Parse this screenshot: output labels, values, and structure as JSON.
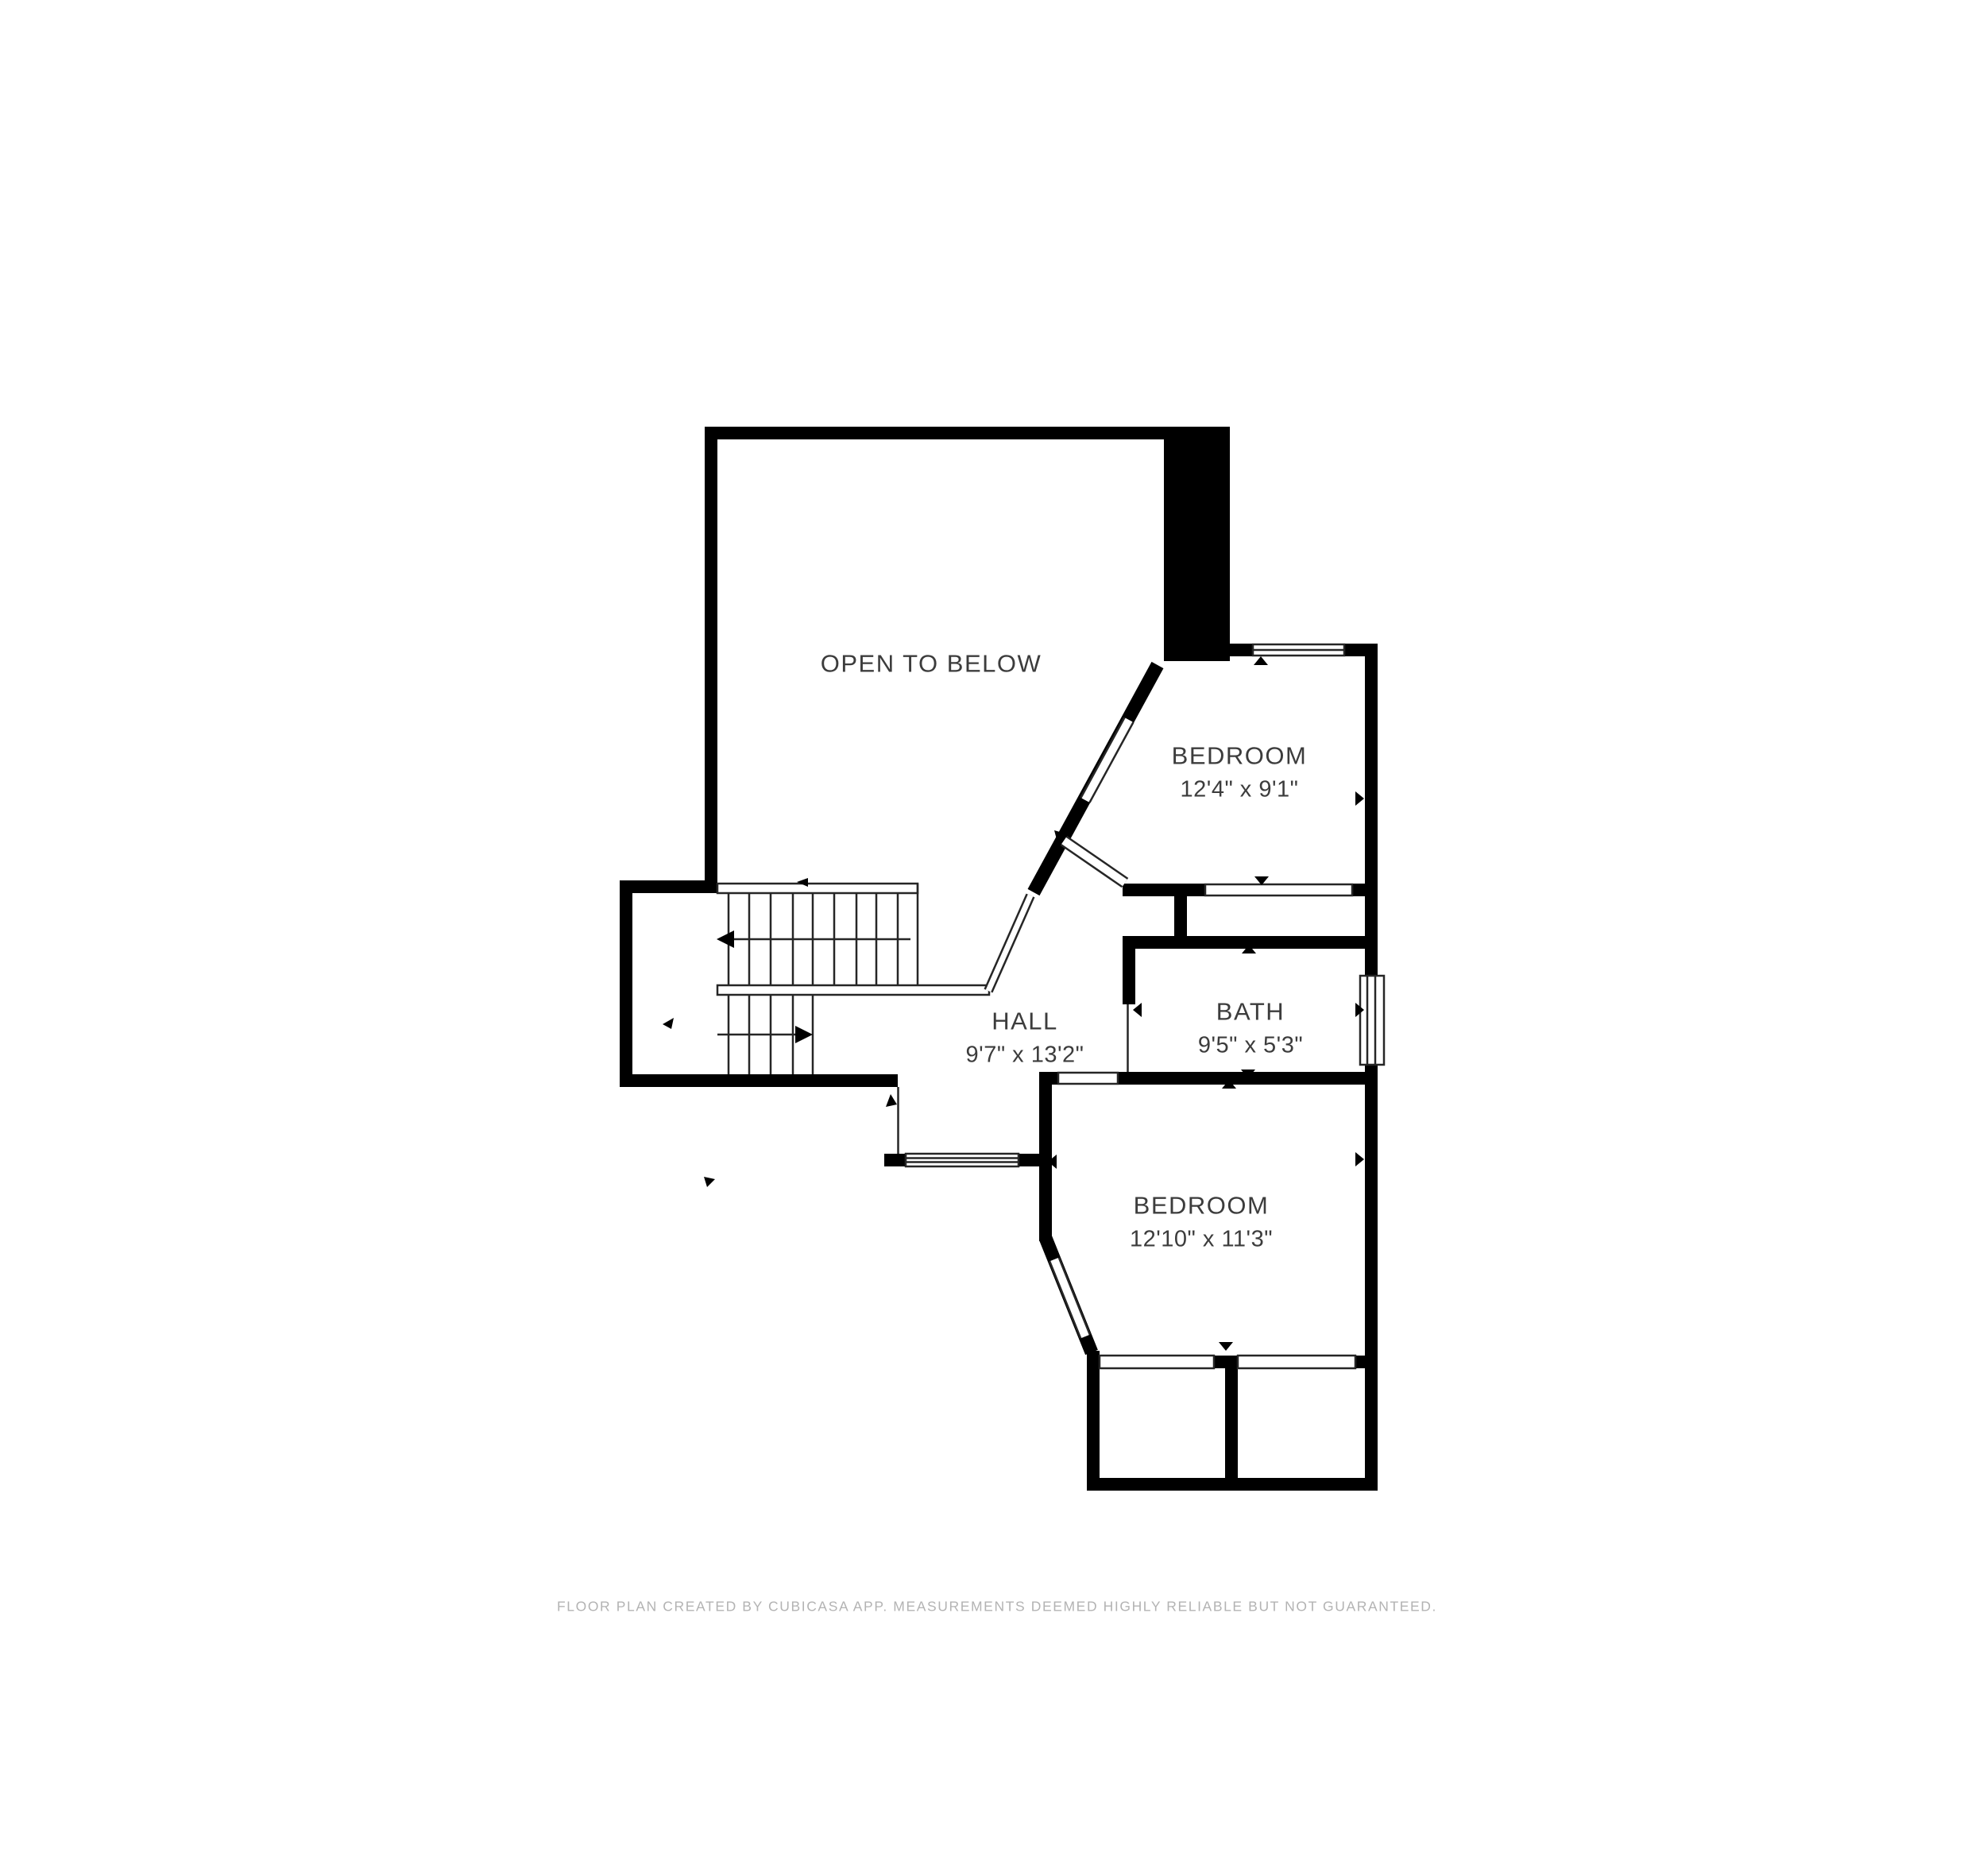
{
  "plan": {
    "type": "floor-plan",
    "rooms": {
      "open_to_below": {
        "name": "OPEN TO BELOW"
      },
      "bedroom_top": {
        "name": "BEDROOM",
        "dims": "12'4\" x 9'1\""
      },
      "hall": {
        "name": "HALL",
        "dims": "9'7\" x 13'2\""
      },
      "bath": {
        "name": "BATH",
        "dims": "9'5\" x 5'3\""
      },
      "bedroom_bottom": {
        "name": "BEDROOM",
        "dims": "12'10\" x 11'3\""
      }
    },
    "colors": {
      "wall": "#000000",
      "thin_line": "#262626",
      "label_text": "#3c3c3c",
      "footer_text": "#b3b3b3",
      "background": "#ffffff"
    }
  },
  "footer": {
    "disclaimer": "FLOOR PLAN CREATED BY CUBICASA APP. MEASUREMENTS DEEMED HIGHLY RELIABLE BUT NOT GUARANTEED."
  }
}
